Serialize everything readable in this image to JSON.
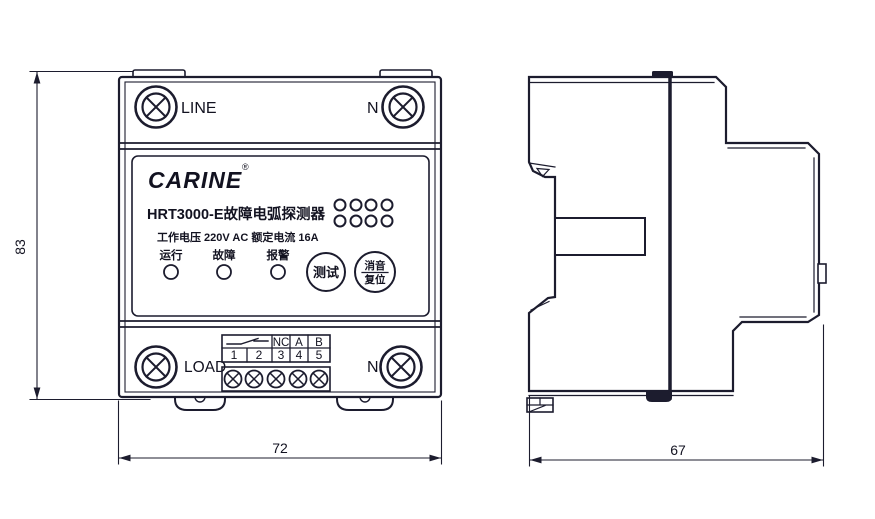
{
  "document_type": "technical dimension drawing",
  "dimensions": {
    "height": "83",
    "width": "72",
    "depth": "67"
  },
  "front_view": {
    "top": {
      "left_terminal": "LINE",
      "right_terminal": "N"
    },
    "panel": {
      "brand": "CARINE",
      "trademark": "®",
      "model": "HRT3000-E故障电弧探测器",
      "specs": "工作电压 220V AC 额定电流 16A",
      "indicators": [
        "运行",
        "故障",
        "报警"
      ],
      "test_button": "测试",
      "mute_reset_button": {
        "top": "消音",
        "bottom": "复位"
      }
    },
    "bottom": {
      "left_terminal": "LOAD",
      "right_terminal": "N",
      "terminal_block": {
        "headers": [
          "NC",
          "A",
          "B"
        ],
        "numbers": [
          "1",
          "2",
          "3",
          "4",
          "5"
        ]
      }
    }
  },
  "colors": {
    "line_ink": "#1c1c2e",
    "background": "#ffffff"
  }
}
